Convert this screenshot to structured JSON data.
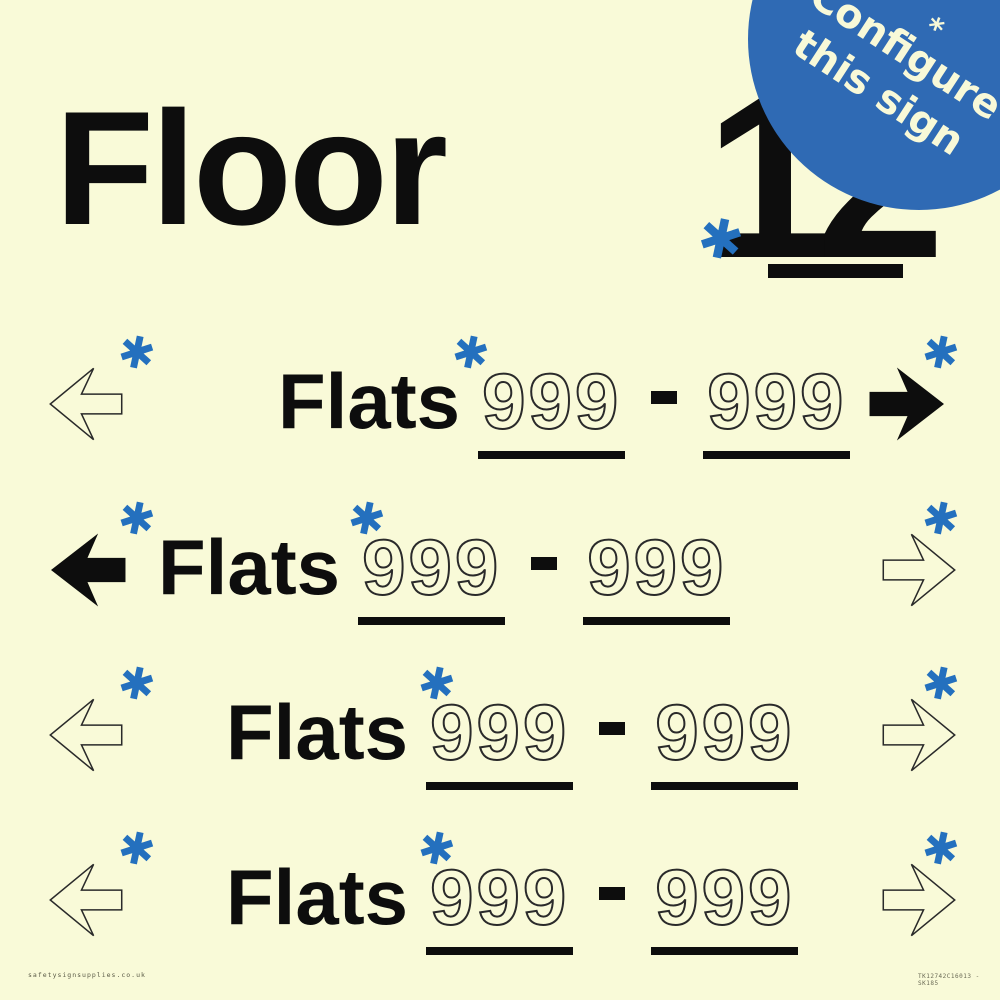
{
  "colors": {
    "background": "#F9FAD8",
    "badge_blue": "#2F6AB4",
    "asterisk_blue": "#2470BE",
    "ink": "#0D0D0D"
  },
  "header": {
    "title": "Floor",
    "floor_number": "12",
    "asterisk": "✱"
  },
  "badge": {
    "line1": "Configure",
    "line2": "this sign",
    "asterisk": "*"
  },
  "rows": [
    {
      "label": "Flats",
      "range_start": "999",
      "range_end": "999",
      "left_arrow": "outline",
      "right_arrow": "filled",
      "asterisk": "✱",
      "text_left": 278,
      "ast_mid_left": 452
    },
    {
      "label": "Flats",
      "range_start": "999",
      "range_end": "999",
      "left_arrow": "filled",
      "right_arrow": "outline",
      "asterisk": "✱",
      "text_left": 158,
      "ast_mid_left": 348
    },
    {
      "label": "Flats",
      "range_start": "999",
      "range_end": "999",
      "left_arrow": "outline",
      "right_arrow": "outline",
      "asterisk": "✱",
      "text_left": 226,
      "ast_mid_left": 418
    },
    {
      "label": "Flats",
      "range_start": "999",
      "range_end": "999",
      "left_arrow": "outline",
      "right_arrow": "outline",
      "asterisk": "✱",
      "text_left": 226,
      "ast_mid_left": 418
    }
  ],
  "footer": {
    "website": "safetysignsupplies.co.uk",
    "product_code": "TK12742C16013 - SK185"
  }
}
